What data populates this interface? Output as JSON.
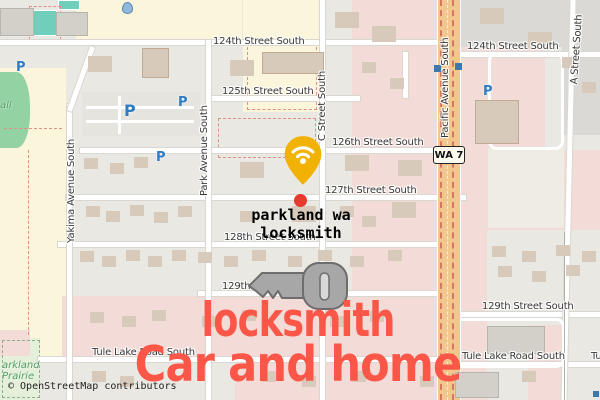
{
  "street_labels": {
    "s124_left": "124th Street South",
    "s124_right": "124th Street South",
    "s125": "125th Street South",
    "s126": "126th Street South",
    "s127": "127th Street South",
    "s128": "128th Street South",
    "s129_left": "129th",
    "s129_right": "129th Street South",
    "tule_left": "Tule Lake Road South",
    "tule_right": "Tule Lake Road South",
    "tule_partial": "Tu",
    "yakima": "Yakima Avenue South",
    "park": "Park Avenue South",
    "c_street": "C Street South",
    "pacific": "Pacific Avenue South",
    "a_street": "A Street South"
  },
  "badges": {
    "route": "WA 7"
  },
  "symbols": {
    "parking": "P"
  },
  "poi": {
    "line1": "parkland wa",
    "line2": "locksmith"
  },
  "park_labels": {
    "mall_partial": "all",
    "prairie_line1": "arkland",
    "prairie_line2": "Prairie"
  },
  "overlay": {
    "headline1": "locksmith",
    "headline2": "Car and home",
    "headline_color": "#FB5749"
  },
  "colors": {
    "pin": "#F1B204",
    "marker_dot": "#E53A2C",
    "key_fill": "#A7A7A7",
    "key_outline": "#6D6D6D",
    "pacific_road": "#F2C78E",
    "retail_pink": "#F3DBD7",
    "school_cream": "#FBF5DC",
    "park_green": "#93D2A3"
  },
  "attribution": "© OpenStreetMap contributors"
}
